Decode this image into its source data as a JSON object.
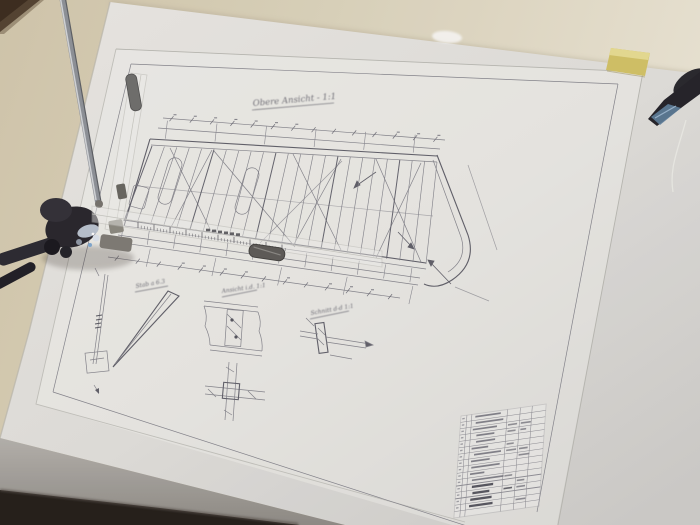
{
  "drawing": {
    "title": "Obere Ansicht - 1:1",
    "details": [
      {
        "heading": "Stab a 6.3"
      },
      {
        "heading": "Ansicht i.d. 1:1"
      },
      {
        "heading": "Schnitt d-d 1:1"
      }
    ]
  },
  "objects": {
    "drafting_machine": "drafting-machine-head",
    "vertical_ruler": "transparent-scale-ruler",
    "horizontal_ruler": "transparent-scale-ruler",
    "sticky_note": "yellow-sticky-note",
    "tool": "dark-tool-handle",
    "title_block": "parts-list-table"
  },
  "colors": {
    "table_surface": "#d8cfb4",
    "backing_paper": "#e8e7e3",
    "pencil_line": "#84848c",
    "sticky_note": "#d3c366",
    "drafting_head": "#26242b",
    "ruler_grip": "#5c5a57",
    "floor_edge": "#221d18"
  }
}
